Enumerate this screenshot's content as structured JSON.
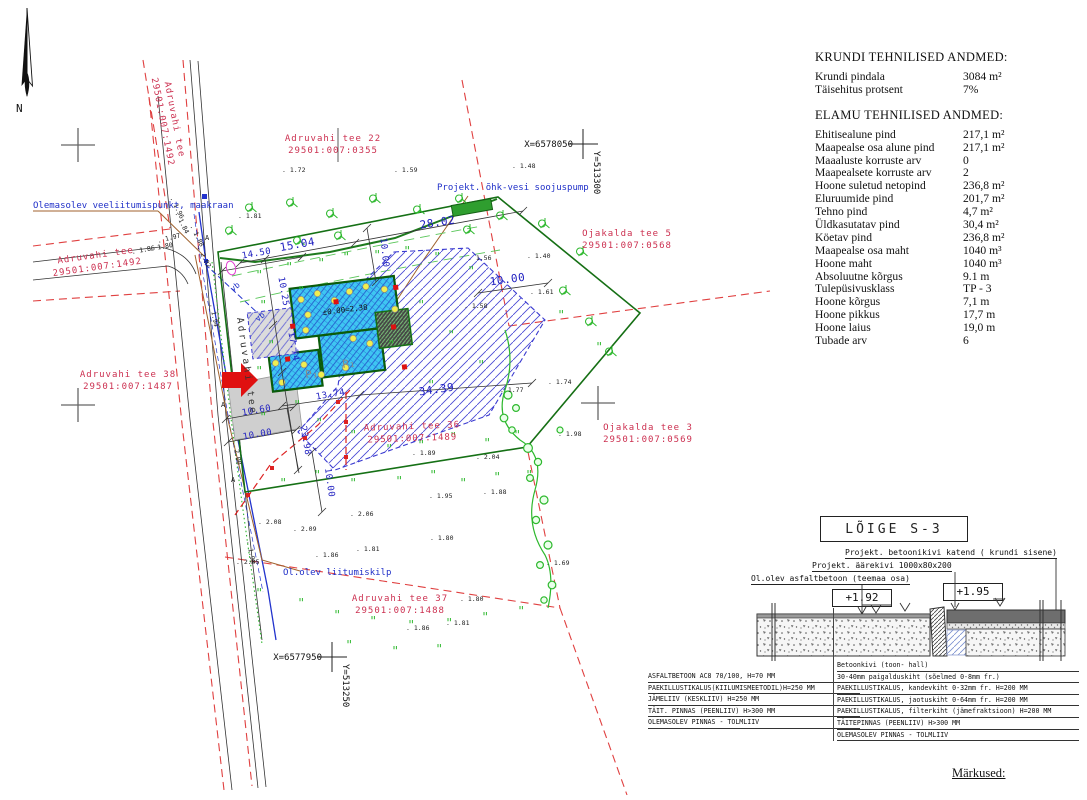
{
  "plan": {
    "north_label": "N",
    "road_label_vertical": "Adruvahi tee",
    "a_label": "A",
    "vb_label": "vb",
    "building": {
      "level": "±0.00=2.38",
      "p1": "P₁",
      "p2": "P₁"
    },
    "parcels": [
      {
        "l1": "Adruvahi tee 22",
        "l2": "29501:007:0355",
        "x": 333,
        "y": 141,
        "r": 0
      },
      {
        "l1": "Adruvahi tee",
        "l2": "29501:007:1492",
        "x": 172,
        "y": 120,
        "r": 79
      },
      {
        "l1": "Adruvahi tee",
        "l2": "29501:007:1492",
        "x": 96,
        "y": 258,
        "r": -8
      },
      {
        "l1": "Ojakalda tee 5",
        "l2": "29501:007:0568",
        "x": 627,
        "y": 236,
        "r": 0
      },
      {
        "l1": "Adruvahi tee 38",
        "l2": "29501:007:1487",
        "x": 128,
        "y": 377,
        "r": 0
      },
      {
        "l1": "Adruvahi tee 36",
        "l2": "29501:007:1489",
        "x": 412,
        "y": 429,
        "r": -2
      },
      {
        "l1": "Ojakalda tee 3",
        "l2": "29501:007:0569",
        "x": 648,
        "y": 430,
        "r": 0
      },
      {
        "l1": "Adruvahi tee 37",
        "l2": "29501:007:1488",
        "x": 400,
        "y": 601,
        "r": 0
      }
    ],
    "annotations": [
      {
        "text": "Olemasolev veeliitumispunkt, maakraan",
        "x": 33,
        "y": 208
      },
      {
        "text": "Projekt. õhk-vesi soojuspump",
        "x": 437,
        "y": 190
      },
      {
        "text": "Ol.olev liitumiskilp",
        "x": 283,
        "y": 575
      }
    ],
    "coords": [
      {
        "x_label": "X=6578050",
        "y_label": "Y=513300",
        "x": 583,
        "y": 144
      },
      {
        "x_label": "X=6577950",
        "y_label": "Y=513250",
        "x": 332,
        "y": 657
      }
    ],
    "dimensions": [
      {
        "v": "15.04",
        "x": 298,
        "y": 248,
        "r": -10,
        "s": 11
      },
      {
        "v": "28.02",
        "x": 438,
        "y": 226,
        "r": -9,
        "s": 11
      },
      {
        "v": "14.50",
        "x": 257,
        "y": 256,
        "r": -10,
        "s": 9
      },
      {
        "v": "10.25",
        "x": 281,
        "y": 292,
        "r": 80,
        "s": 9
      },
      {
        "v": "10.00",
        "x": 382,
        "y": 253,
        "r": 84,
        "s": 9
      },
      {
        "v": "10.00",
        "x": 508,
        "y": 283,
        "r": -8,
        "s": 11
      },
      {
        "v": "17.74",
        "x": 291,
        "y": 347,
        "r": 80,
        "s": 9
      },
      {
        "v": "34.39",
        "x": 437,
        "y": 393,
        "r": -8,
        "s": 11
      },
      {
        "v": "13.74",
        "x": 331,
        "y": 397,
        "r": -10,
        "s": 9
      },
      {
        "v": "10.60",
        "x": 257,
        "y": 413,
        "r": -10,
        "s": 9
      },
      {
        "v": "10.00",
        "x": 258,
        "y": 437,
        "r": -10,
        "s": 9
      },
      {
        "v": "23.98",
        "x": 303,
        "y": 441,
        "r": 80,
        "s": 9
      },
      {
        "v": "10.00",
        "x": 327,
        "y": 483,
        "r": 82,
        "s": 9
      }
    ],
    "spots": [
      {
        "v": "1.72",
        "x": 282,
        "y": 172
      },
      {
        "v": "1.59",
        "x": 394,
        "y": 172
      },
      {
        "v": "1.48",
        "x": 512,
        "y": 168
      },
      {
        "v": "1.81",
        "x": 238,
        "y": 218
      },
      {
        "v": "1.40",
        "x": 527,
        "y": 258
      },
      {
        "v": "1.56",
        "x": 468,
        "y": 260
      },
      {
        "v": "1.61",
        "x": 530,
        "y": 294
      },
      {
        "v": "1.58",
        "x": 464,
        "y": 308
      },
      {
        "v": "1.74",
        "x": 548,
        "y": 384
      },
      {
        "v": "1.77",
        "x": 500,
        "y": 392
      },
      {
        "v": "1.98",
        "x": 558,
        "y": 436
      },
      {
        "v": "1.89",
        "x": 412,
        "y": 455
      },
      {
        "v": "2.04",
        "x": 476,
        "y": 459
      },
      {
        "v": "1.88",
        "x": 483,
        "y": 494
      },
      {
        "v": "1.95",
        "x": 429,
        "y": 498
      },
      {
        "v": "1.69",
        "x": 546,
        "y": 565
      },
      {
        "v": "2.06",
        "x": 350,
        "y": 516
      },
      {
        "v": "2.08",
        "x": 258,
        "y": 524
      },
      {
        "v": "2.09",
        "x": 293,
        "y": 531
      },
      {
        "v": "1.86",
        "x": 315,
        "y": 557
      },
      {
        "v": "1.81",
        "x": 356,
        "y": 551
      },
      {
        "v": "1.80",
        "x": 430,
        "y": 540
      },
      {
        "v": "2.05",
        "x": 236,
        "y": 564
      },
      {
        "v": "1.86",
        "x": 406,
        "y": 630
      },
      {
        "v": "1.81",
        "x": 446,
        "y": 625
      },
      {
        "v": "1.80",
        "x": 460,
        "y": 601
      },
      {
        "v": "1.96",
        "x": 170,
        "y": 198,
        "r": 64
      },
      {
        "v": "1.84",
        "x": 175,
        "y": 213,
        "r": 64
      },
      {
        "v": "1.97",
        "x": 158,
        "y": 243,
        "r": -14
      },
      {
        "v": "1.86",
        "x": 132,
        "y": 254,
        "r": -10
      },
      {
        "v": "1.80",
        "x": 150,
        "y": 251,
        "r": -10
      },
      {
        "v": "1.88",
        "x": 190,
        "y": 226,
        "r": 64
      },
      {
        "v": "2.02",
        "x": 197,
        "y": 247,
        "r": 64
      },
      {
        "v": "1.94",
        "x": 210,
        "y": 304,
        "r": 80
      },
      {
        "v": "2.00",
        "x": 233,
        "y": 442,
        "r": 80
      },
      {
        "v": "1.98",
        "x": 247,
        "y": 541,
        "r": 80
      }
    ]
  },
  "tech": {
    "krundi_title": "KRUNDI TEHNILISED ANDMED:",
    "krundi_rows": [
      [
        "Krundi pindala",
        "3084 m²"
      ],
      [
        "Täisehitus protsent",
        "7%"
      ]
    ],
    "elamu_title": "ELAMU TEHNILISED ANDMED:",
    "elamu_rows": [
      [
        "Ehitisealune pind",
        "217,1 m²"
      ],
      [
        "Maapealse osa alune pind",
        "217,1 m²"
      ],
      [
        "Maaaluste korruste arv",
        "0"
      ],
      [
        "Maapealsete korruste arv",
        "2"
      ],
      [
        "Hoone suletud netopind",
        "236,8 m²"
      ],
      [
        "Eluruumide pind",
        "201,7 m²"
      ],
      [
        "Tehno pind",
        "4,7 m²"
      ],
      [
        "Üldkasutatav pind",
        "30,4 m²"
      ],
      [
        "Köetav pind",
        "236,8 m²"
      ],
      [
        "Maapealse osa maht",
        "1040 m³"
      ],
      [
        "Hoone maht",
        "1040 m³"
      ],
      [
        "Absoluutne kõrgus",
        "9.1 m"
      ],
      [
        "Tulepüsivusklass",
        "TP - 3"
      ],
      [
        "Hoone kõrgus",
        "7,1 m"
      ],
      [
        "Hoone pikkus",
        "17,7 m"
      ],
      [
        "Hoone laius",
        "19,0 m"
      ],
      [
        "Tubade arv",
        "6"
      ]
    ]
  },
  "section": {
    "title": "LÕIGE S-3",
    "label_top": "Projekt. betoonikivi katend ( krundi sisene)",
    "label_mid": "Projekt. äärekivi 1000x80x200",
    "label_low": "Ol.olev asfaltbetoon (teemaa osa)",
    "elev_left": "+1.92",
    "elev_right": "+1.95",
    "layers_left": [
      "ASFALTBETOON AC8 70/100, H=70 MM",
      "PAEKILLUSTIKALUS(KIILUMISMEETODIL)H=250 MM",
      "JÄMELIIV (KESKLIIV)      H=250 MM",
      "TÄIT. PINNAS (PEENLIIV)    H>300 MM",
      "OLEMASOLEV PINNAS - TOLMLIIV"
    ],
    "layers_right": [
      "Betoonkivi (toon- hall)",
      "30-40mm paigalduskiht (sõelmed 0-8mm fr.)",
      "PAEKILLUSTIKALUS, kandevkiht 0-32mm fr. H=200 MM",
      "PAEKILLUSTIKALUS, jaotuskiht 0-64mm fr. H=200 MM",
      "PAEKILLUSTIKALUS, filterkiht (jämefraktsioon) H=200 MM",
      "TÄITEPINNAS (PEENLIIV)      H>300 MM",
      "OLEMASOLEV PINNAS - TOLMLIIV"
    ]
  },
  "footer": {
    "markused": "Märkused:"
  }
}
